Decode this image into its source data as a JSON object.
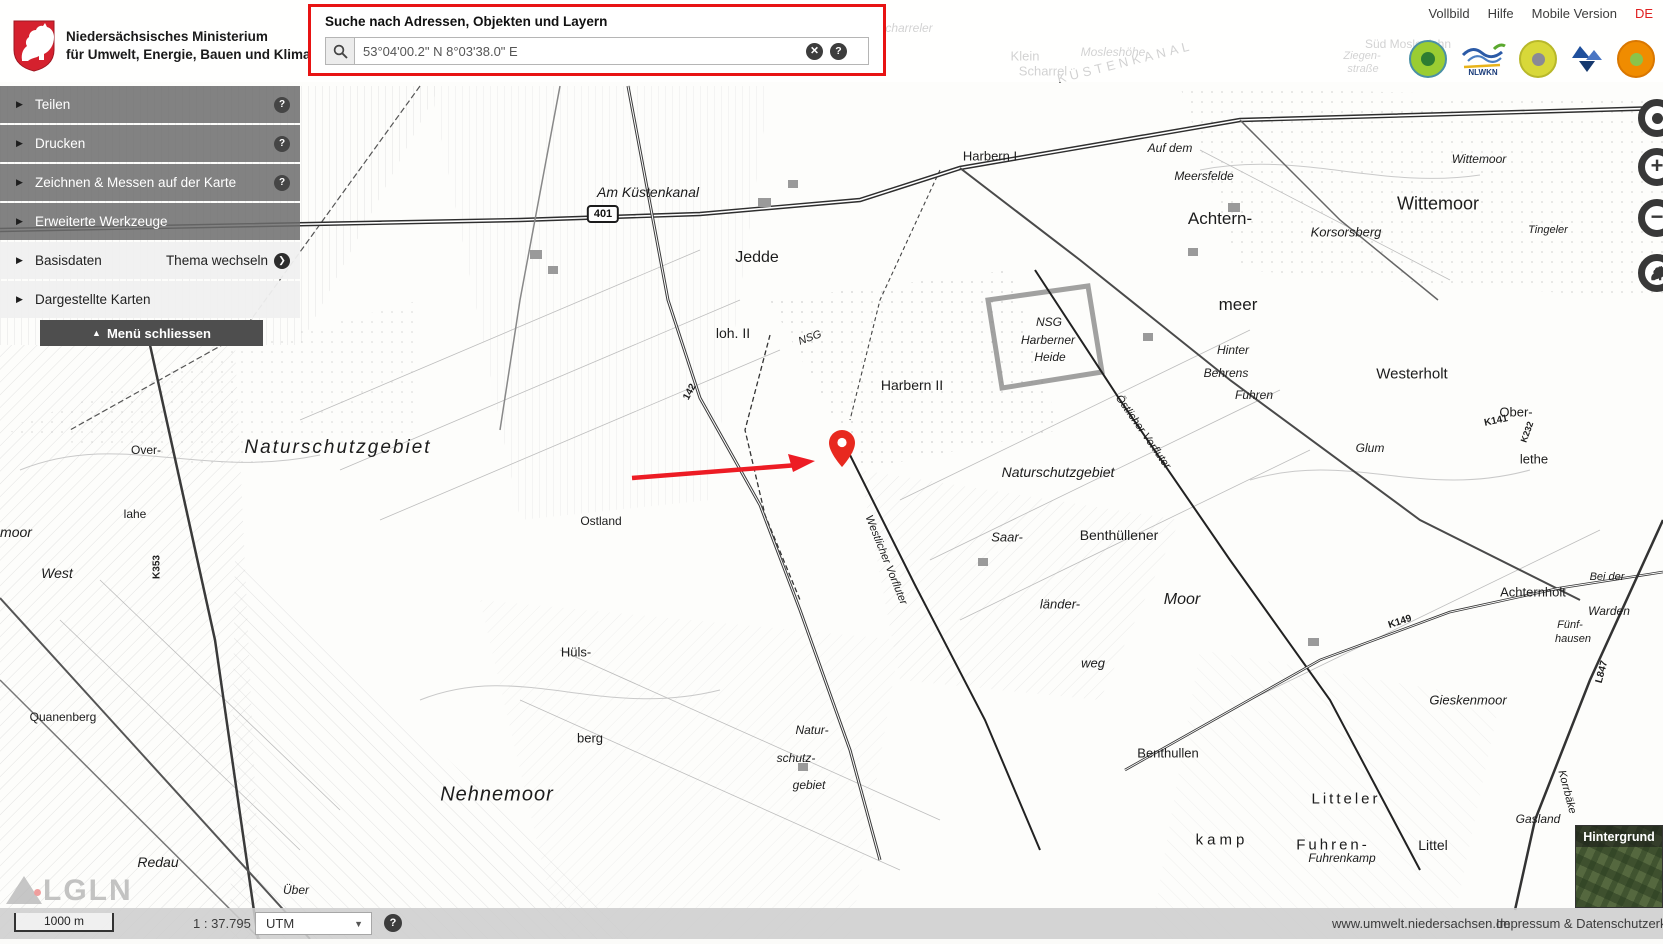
{
  "header": {
    "ministry_line1": "Niedersächsisches Ministerium",
    "ministry_line2": "für Umwelt, Energie, Bauen und Klimaschutz",
    "links": [
      "Vollbild",
      "Hilfe",
      "Mobile Version",
      "DE"
    ],
    "nlwkn_logo_text": "NLWKN"
  },
  "search": {
    "label": "Suche nach Adressen, Objekten und Layern",
    "value": "53°04'00.2\" N 8°03'38.0\" E",
    "highlight_color": "#e81313"
  },
  "icons": {
    "help": "?",
    "clear": "✕",
    "arrow_right": "▶",
    "chevron": "❯",
    "menu_up": "▲",
    "dropdown": "▼",
    "plus": "+",
    "minus": "−"
  },
  "sidebar": {
    "items": [
      {
        "label": "Teilen",
        "help": true,
        "style": "dark"
      },
      {
        "label": "Drucken",
        "help": true,
        "style": "dark"
      },
      {
        "label": "Zeichnen & Messen auf der Karte",
        "help": true,
        "style": "dark"
      },
      {
        "label": "Erweiterte Werkzeuge",
        "help": false,
        "style": "dark"
      },
      {
        "label": "Basisdaten",
        "action": "Thema wechseln",
        "style": "light"
      },
      {
        "label": "Dargestellte Karten",
        "style": "light"
      }
    ],
    "close_label": "Menü schliessen"
  },
  "map_controls": {
    "locate": "locate",
    "zoom_in": "+",
    "zoom_out": "−",
    "home": "lower-saxony-horse"
  },
  "footer": {
    "scale_bar": "1000 m",
    "scale_ratio": "1 : 37.795",
    "projection": "UTM",
    "site_link": "www.umwelt.niedersachsen.de",
    "imprint_link": "Impressum & Datenschutzerklärung"
  },
  "background_switcher": {
    "label": "Hintergrund"
  },
  "watermark": {
    "text": "LGLN"
  },
  "marker": {
    "x": 842,
    "y": 467,
    "color": "#e8291f"
  },
  "arrow": {
    "x1": 632,
    "y1": 478,
    "x2": 815,
    "y2": 461,
    "color": "#ed1c24"
  },
  "map": {
    "road_badge": {
      "text": "401"
    },
    "labels": [
      {
        "t": "Scharreler",
        "x": 905,
        "y": 28,
        "s": 12,
        "i": 1
      },
      {
        "t": "Sandberg",
        "x": 648,
        "y": 30,
        "s": 13,
        "i": 1
      },
      {
        "t": "Klein",
        "x": 1025,
        "y": 56,
        "s": 13
      },
      {
        "t": "Scharrel",
        "x": 1043,
        "y": 71,
        "s": 13
      },
      {
        "t": "Mosleshöhe",
        "x": 1113,
        "y": 52,
        "s": 12,
        "i": 1
      },
      {
        "t": "KÜSTENKANAL",
        "x": 1125,
        "y": 62,
        "s": 13,
        "r": -14,
        "ls": 4
      },
      {
        "t": "Ziegen-",
        "x": 1362,
        "y": 56,
        "s": 11,
        "i": 1
      },
      {
        "t": "straße",
        "x": 1363,
        "y": 69,
        "s": 11,
        "i": 1
      },
      {
        "t": "Süd Moslesfehn",
        "x": 1408,
        "y": 44,
        "s": 12
      },
      {
        "t": "Am Küstenkanal",
        "x": 648,
        "y": 192,
        "s": 14,
        "i": 1
      },
      {
        "t": "Jedde",
        "x": 757,
        "y": 258,
        "s": 16
      },
      {
        "t": "loh. II",
        "x": 733,
        "y": 333,
        "s": 14
      },
      {
        "t": "NSG",
        "x": 810,
        "y": 338,
        "s": 11,
        "i": 1,
        "r": -20
      },
      {
        "t": "Harbern I",
        "x": 990,
        "y": 156,
        "s": 13
      },
      {
        "t": "NSG",
        "x": 1049,
        "y": 322,
        "s": 12,
        "i": 1
      },
      {
        "t": "Harberner",
        "x": 1048,
        "y": 340,
        "s": 12,
        "i": 1
      },
      {
        "t": "Heide",
        "x": 1050,
        "y": 357,
        "s": 12,
        "i": 1
      },
      {
        "t": "Harbern II",
        "x": 912,
        "y": 385,
        "s": 14
      },
      {
        "t": "Auf dem",
        "x": 1170,
        "y": 148,
        "s": 12,
        "i": 1
      },
      {
        "t": "Meersfelde",
        "x": 1204,
        "y": 176,
        "s": 12,
        "i": 1
      },
      {
        "t": "Achtern-",
        "x": 1220,
        "y": 219,
        "s": 17
      },
      {
        "t": "meer",
        "x": 1238,
        "y": 305,
        "s": 17
      },
      {
        "t": "Wittemoor",
        "x": 1479,
        "y": 159,
        "s": 12,
        "i": 1
      },
      {
        "t": "Wittemoor",
        "x": 1438,
        "y": 204,
        "s": 18
      },
      {
        "t": "Korsorsberg",
        "x": 1346,
        "y": 232,
        "s": 13,
        "i": 1
      },
      {
        "t": "Tingeler",
        "x": 1548,
        "y": 230,
        "s": 11,
        "i": 1
      },
      {
        "t": "Hinter",
        "x": 1233,
        "y": 350,
        "s": 12,
        "i": 1
      },
      {
        "t": "Behrens",
        "x": 1226,
        "y": 373,
        "s": 12,
        "i": 1
      },
      {
        "t": "Fuhren",
        "x": 1254,
        "y": 395,
        "s": 12,
        "i": 1
      },
      {
        "t": "Westerholt",
        "x": 1412,
        "y": 374,
        "s": 15
      },
      {
        "t": "K141",
        "x": 1496,
        "y": 421,
        "s": 10,
        "b": 1,
        "r": -12
      },
      {
        "t": "Ober-",
        "x": 1516,
        "y": 412,
        "s": 13
      },
      {
        "t": "K232",
        "x": 1527,
        "y": 432,
        "s": 9,
        "b": 1,
        "r": -70
      },
      {
        "t": "lethe",
        "x": 1534,
        "y": 459,
        "s": 13
      },
      {
        "t": "Glum",
        "x": 1370,
        "y": 448,
        "s": 12,
        "i": 1
      },
      {
        "t": "Naturschutzgebiet",
        "x": 338,
        "y": 448,
        "s": 19,
        "i": 1,
        "ls": 2
      },
      {
        "t": "Naturschutzgebiet",
        "x": 1058,
        "y": 472,
        "s": 14,
        "i": 1
      },
      {
        "t": "Over-",
        "x": 146,
        "y": 450,
        "s": 12
      },
      {
        "t": "lahe",
        "x": 135,
        "y": 514,
        "s": 12
      },
      {
        "t": "moor",
        "x": 16,
        "y": 532,
        "s": 14,
        "i": 1
      },
      {
        "t": "West",
        "x": 57,
        "y": 573,
        "s": 14,
        "i": 1
      },
      {
        "t": "K353",
        "x": 157,
        "y": 567,
        "s": 10,
        "b": 1,
        "r": -90
      },
      {
        "t": "Ostland",
        "x": 601,
        "y": 521,
        "s": 12
      },
      {
        "t": "142",
        "x": 690,
        "y": 392,
        "s": 10,
        "b": 1,
        "r": -62
      },
      {
        "t": "Saar-",
        "x": 1007,
        "y": 537,
        "s": 13,
        "i": 1
      },
      {
        "t": "länder-",
        "x": 1060,
        "y": 604,
        "s": 13,
        "i": 1
      },
      {
        "t": "weg",
        "x": 1093,
        "y": 663,
        "s": 13,
        "i": 1
      },
      {
        "t": "Westlicher Vorfluter",
        "x": 886,
        "y": 560,
        "s": 11,
        "i": 1,
        "r": 68
      },
      {
        "t": "Östlicher Vorfluter",
        "x": 1143,
        "y": 432,
        "s": 11,
        "i": 1,
        "r": 55
      },
      {
        "t": "Benthüllener",
        "x": 1119,
        "y": 535,
        "s": 14
      },
      {
        "t": "Moor",
        "x": 1182,
        "y": 600,
        "s": 16,
        "i": 1
      },
      {
        "t": "K149",
        "x": 1400,
        "y": 622,
        "s": 10,
        "b": 1,
        "r": -18
      },
      {
        "t": "Achternholt",
        "x": 1533,
        "y": 592,
        "s": 13
      },
      {
        "t": "Bei der",
        "x": 1607,
        "y": 577,
        "s": 11,
        "i": 1
      },
      {
        "t": "Warden",
        "x": 1609,
        "y": 611,
        "s": 12,
        "i": 1
      },
      {
        "t": "Fünf-",
        "x": 1570,
        "y": 625,
        "s": 11,
        "i": 1
      },
      {
        "t": "hausen",
        "x": 1573,
        "y": 639,
        "s": 11,
        "i": 1
      },
      {
        "t": "Hüls-",
        "x": 576,
        "y": 652,
        "s": 13
      },
      {
        "t": "berg",
        "x": 590,
        "y": 738,
        "s": 13
      },
      {
        "t": "Quanenberg",
        "x": 63,
        "y": 717,
        "s": 12
      },
      {
        "t": "Nehnemoor",
        "x": 497,
        "y": 795,
        "s": 20,
        "i": 1,
        "ls": 1
      },
      {
        "t": "Natur-",
        "x": 812,
        "y": 730,
        "s": 12,
        "i": 1
      },
      {
        "t": "schutz-",
        "x": 796,
        "y": 758,
        "s": 12,
        "i": 1
      },
      {
        "t": "gebiet",
        "x": 809,
        "y": 785,
        "s": 12,
        "i": 1
      },
      {
        "t": "Benthullen",
        "x": 1168,
        "y": 753,
        "s": 13
      },
      {
        "t": "Gieskenmoor",
        "x": 1468,
        "y": 700,
        "s": 13,
        "i": 1
      },
      {
        "t": "L847",
        "x": 1602,
        "y": 672,
        "s": 10,
        "b": 1,
        "r": -75
      },
      {
        "t": "Litteler",
        "x": 1346,
        "y": 799,
        "s": 15,
        "ls": 3
      },
      {
        "t": "Fuhren-",
        "x": 1333,
        "y": 845,
        "s": 15,
        "ls": 3
      },
      {
        "t": "Fuhrenkamp",
        "x": 1342,
        "y": 858,
        "s": 12,
        "i": 1
      },
      {
        "t": "kamp",
        "x": 1222,
        "y": 840,
        "s": 15,
        "ls": 4
      },
      {
        "t": "Littel",
        "x": 1433,
        "y": 845,
        "s": 14
      },
      {
        "t": "Gasland",
        "x": 1538,
        "y": 819,
        "s": 12,
        "i": 1
      },
      {
        "t": "Korrbäke",
        "x": 1567,
        "y": 792,
        "s": 11,
        "i": 1,
        "r": 75
      },
      {
        "t": "Redau",
        "x": 158,
        "y": 862,
        "s": 14,
        "i": 1
      },
      {
        "t": "Über",
        "x": 296,
        "y": 890,
        "s": 12,
        "i": 1
      }
    ]
  }
}
